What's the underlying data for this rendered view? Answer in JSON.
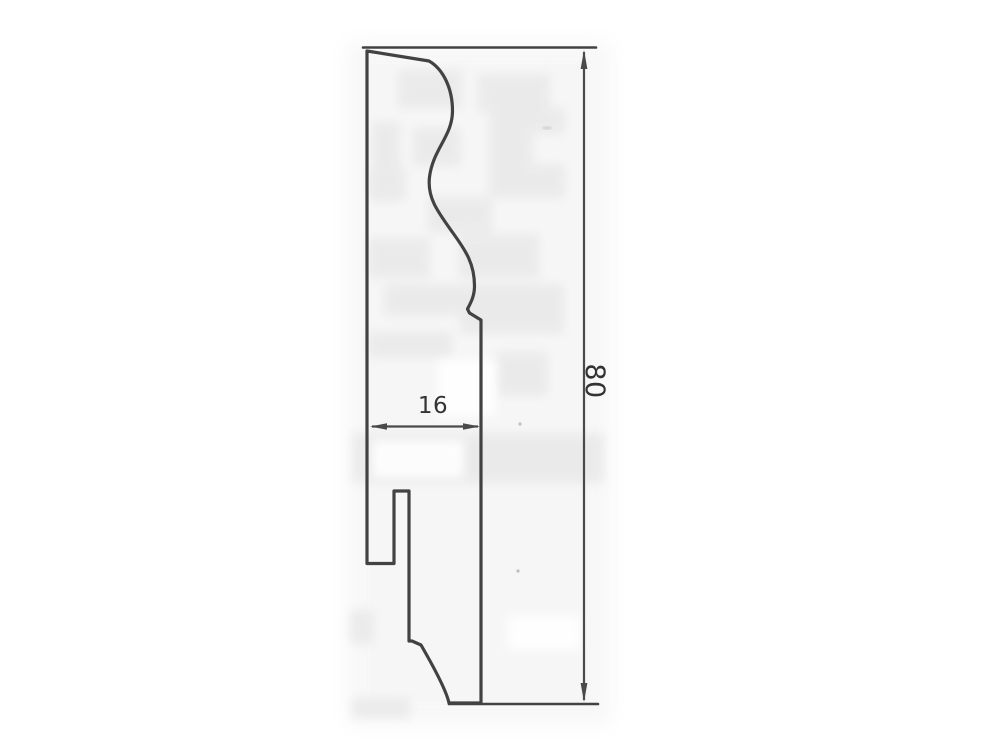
{
  "drawing": {
    "kind": "scanned-technical-drawing",
    "dimension_width": {
      "label": "16",
      "orientation": "horizontal"
    },
    "dimension_height": {
      "label": "80",
      "orientation": "vertical"
    },
    "colors": {
      "line": "#424242",
      "dim_line": "#4a4a4a",
      "text": "#333333",
      "background": "#ffffff",
      "wash": "#f4f4f4",
      "stain": "#e8e8e8",
      "white_patch": "#ffffff"
    }
  }
}
